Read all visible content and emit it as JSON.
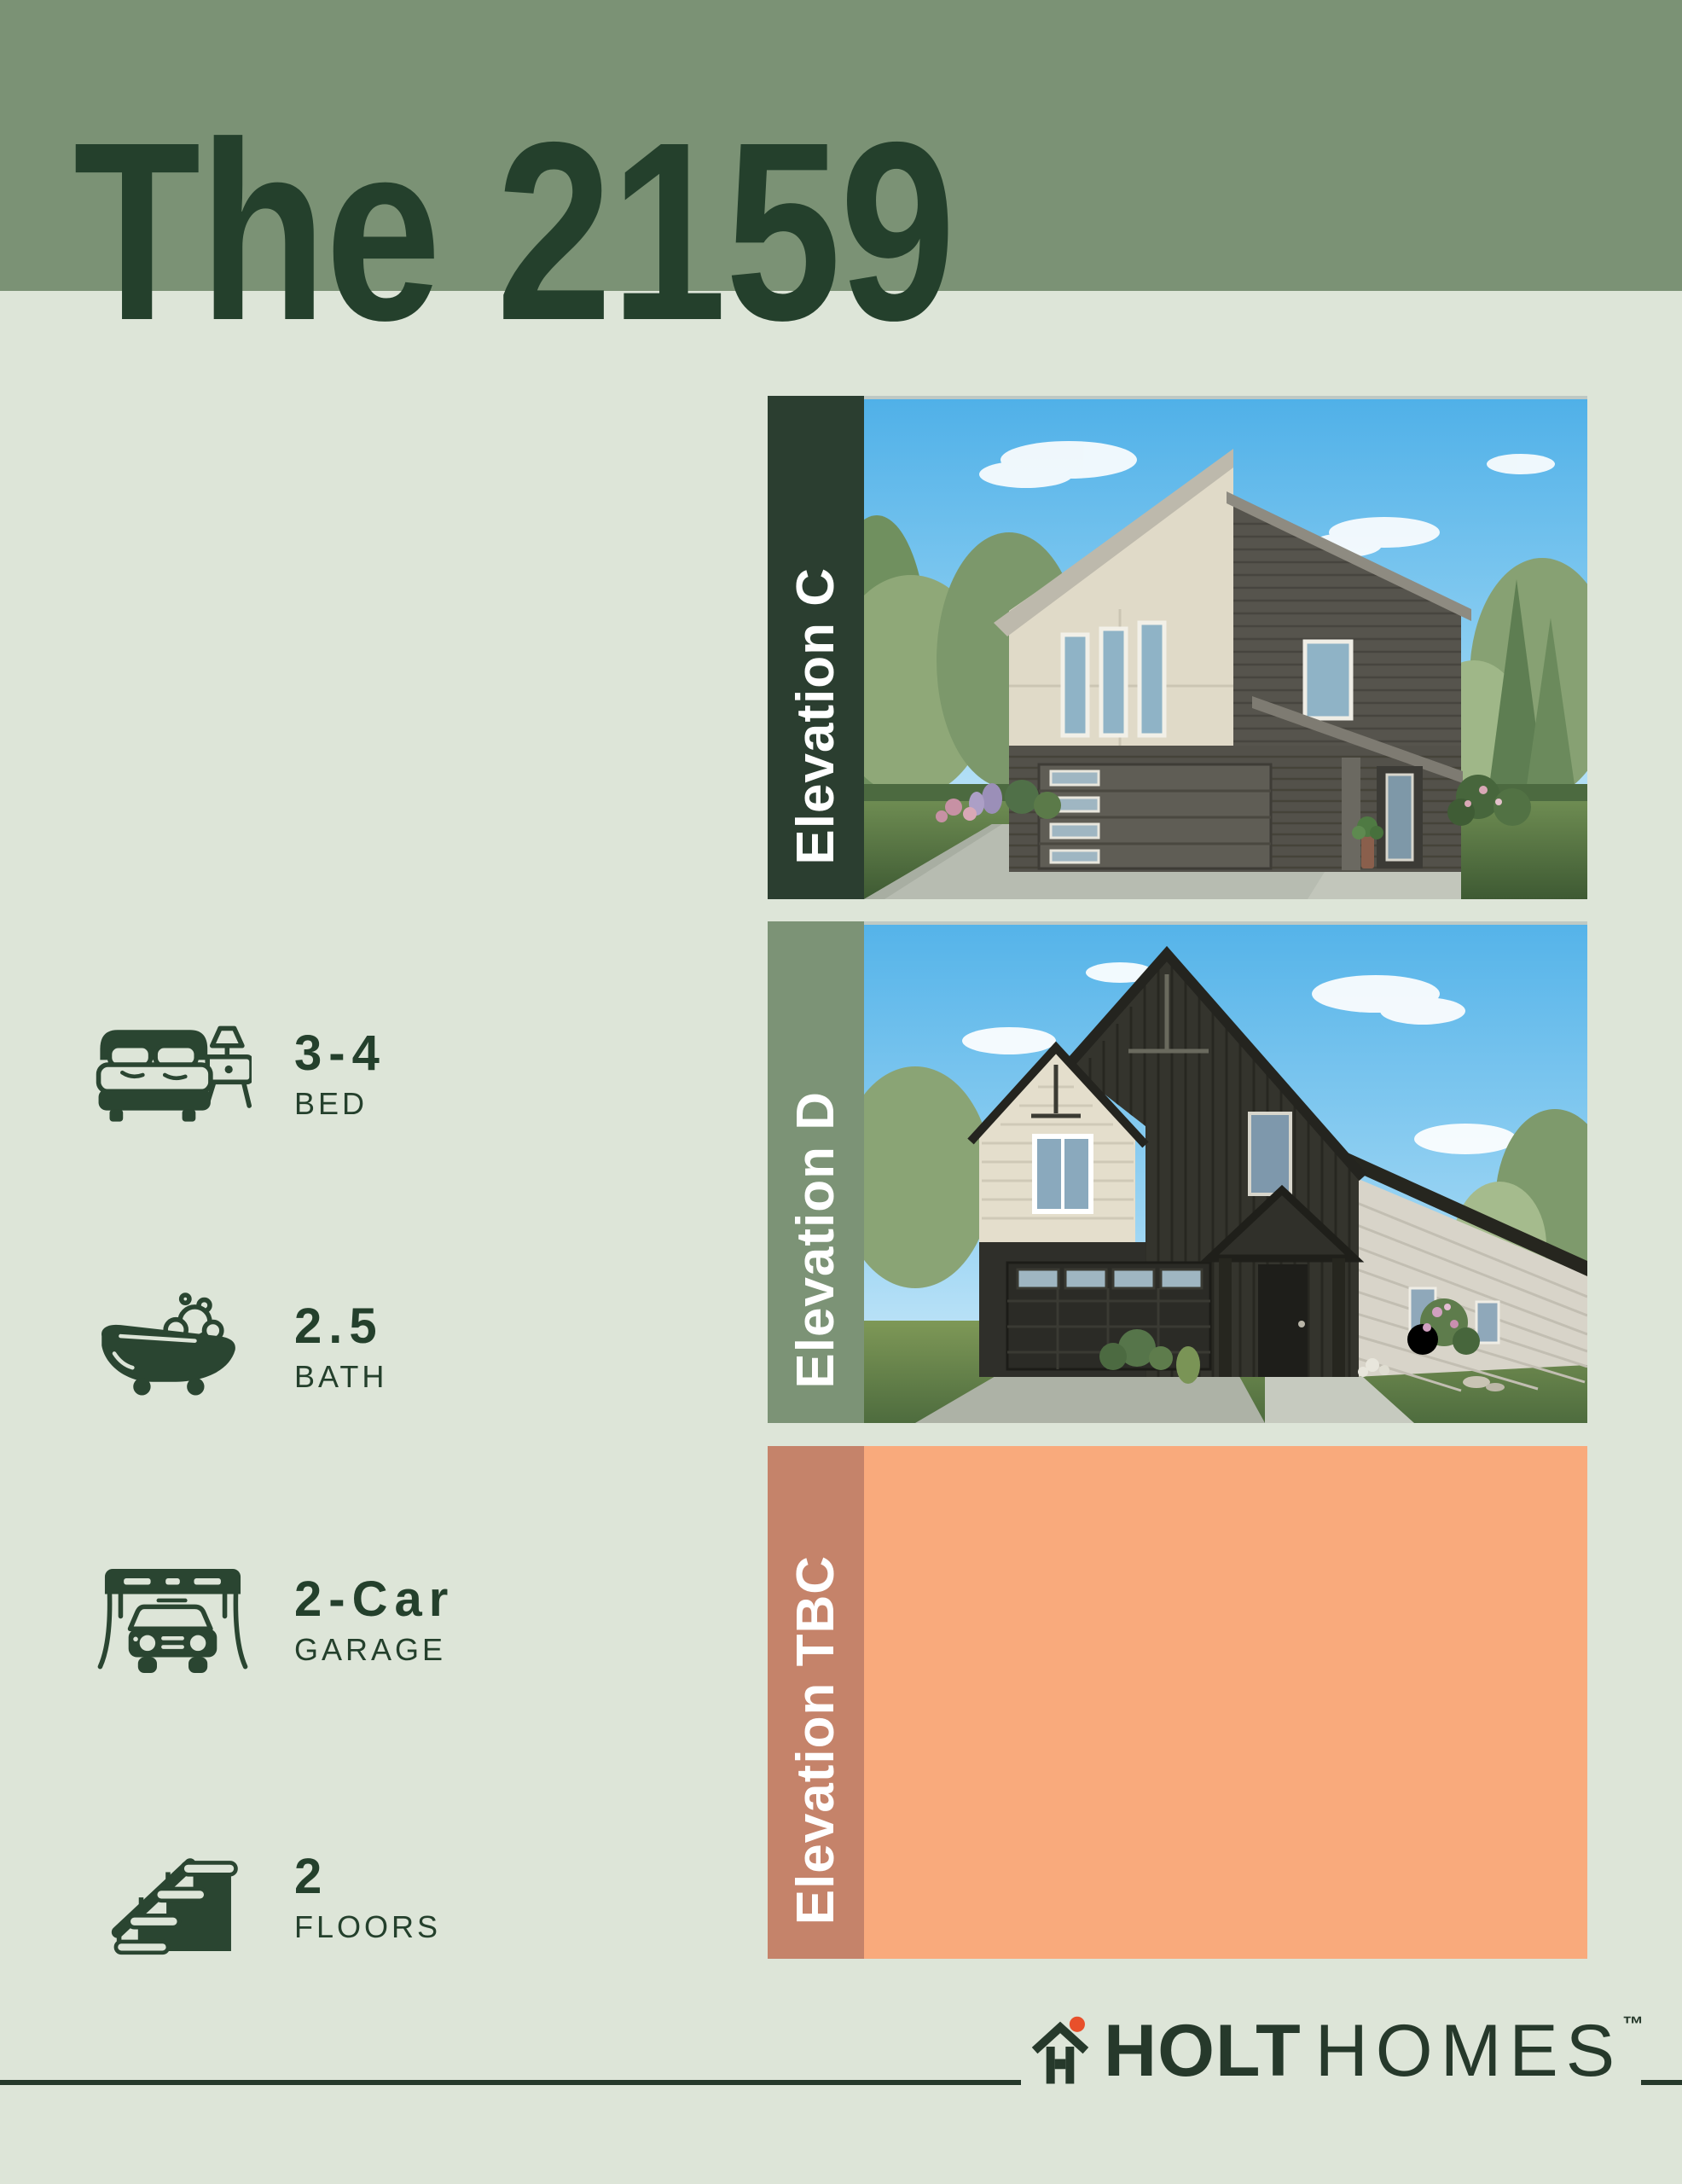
{
  "page": {
    "title": "The 2159"
  },
  "features": [
    {
      "icon": "bed-icon",
      "value": "3-4",
      "label": "BED"
    },
    {
      "icon": "bathtub-icon",
      "value": "2.5",
      "label": "BATH"
    },
    {
      "icon": "garage-icon",
      "value": "2-Car",
      "label": "GARAGE"
    },
    {
      "icon": "stairs-icon",
      "value": "2",
      "label": "FLOORS"
    }
  ],
  "elevations": [
    {
      "label": "Elevation C"
    },
    {
      "label": "Elevation D"
    },
    {
      "label": "Elevation TBC"
    }
  ],
  "footer": {
    "brand_primary": "HOLT",
    "brand_secondary": "HOMES",
    "trademark": "™"
  },
  "colors": {
    "header_band": "#7B9275",
    "background": "#DDE5D8",
    "dark_green": "#24402C",
    "elevation_c_bar": "#2B3E30",
    "elevation_d_bar": "#7C9376",
    "elevation_tbc_bar": "#C5836A",
    "elevation_tbc_body": "#F9AA7C",
    "logo_dot": "#E8502B"
  }
}
